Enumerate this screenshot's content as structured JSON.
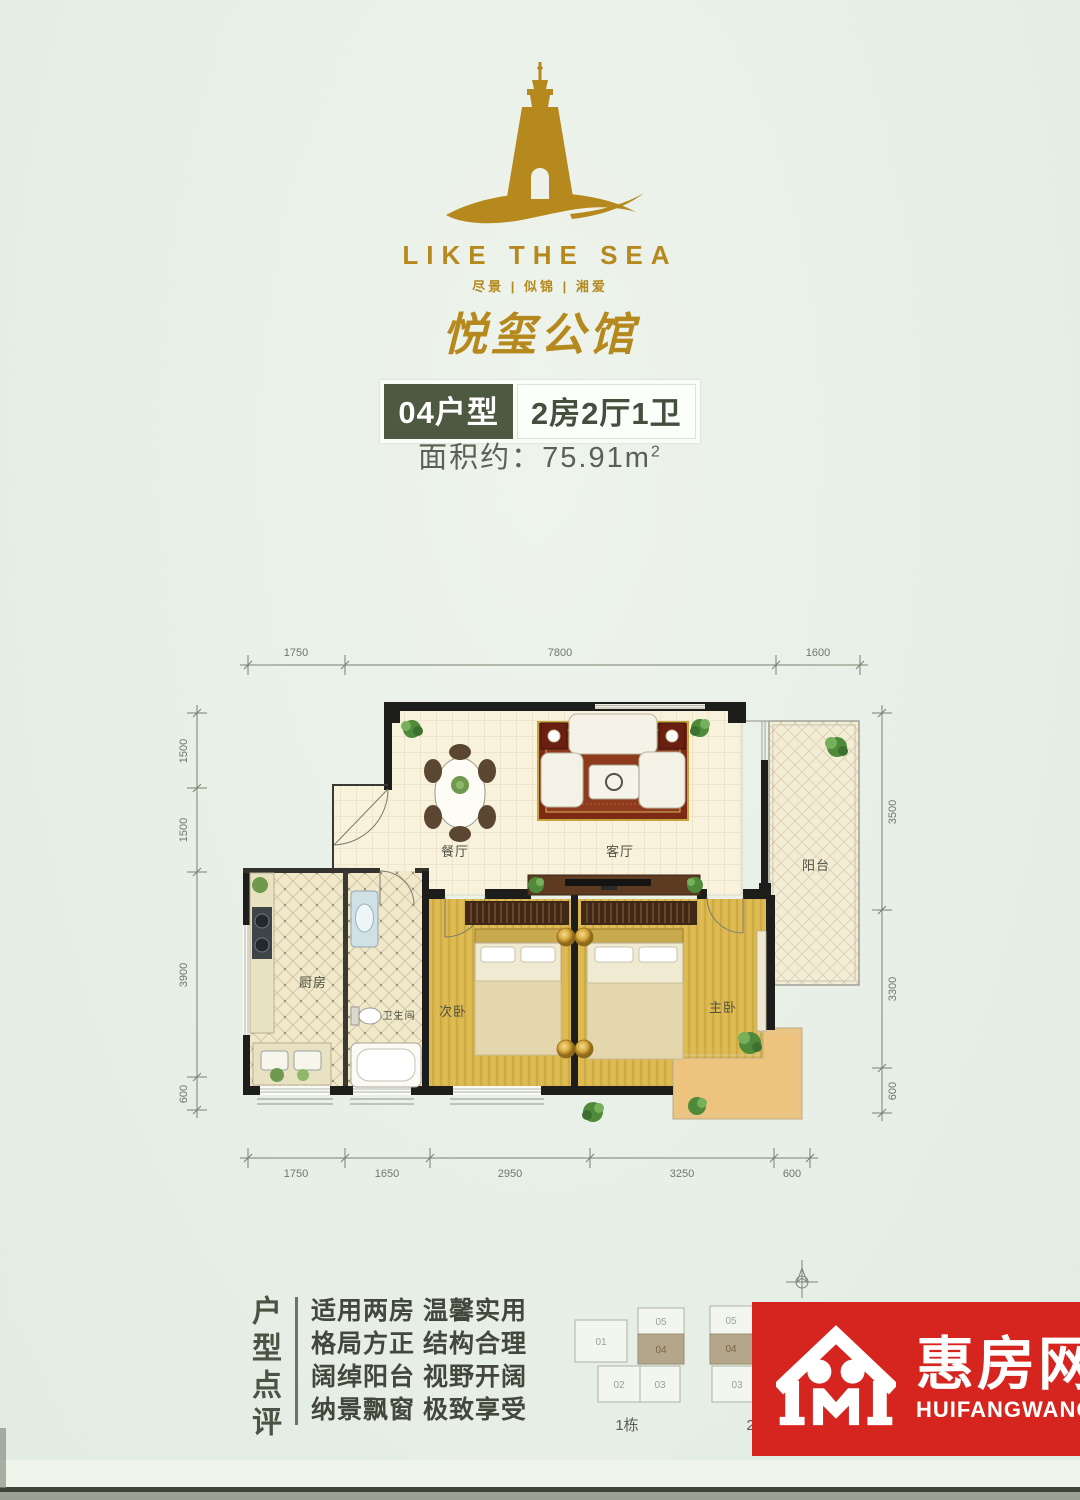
{
  "logo": {
    "en": "LIKE THE SEA",
    "tagline": "尽景 | 似锦 | 湘爱",
    "brand": "悦玺公馆"
  },
  "unit": {
    "type": "04户型",
    "layout": "2房2厅1卫",
    "area_prefix": "面积约：75.91m",
    "area_sup": "2"
  },
  "plan": {
    "rooms": {
      "dining": "餐厅",
      "living": "客厅",
      "balcony": "阳台",
      "kitchen": "厨房",
      "bath": "卫生间",
      "bed2": "次卧",
      "master": "主卧"
    },
    "dims_top": [
      "1750",
      "7800",
      "1600"
    ],
    "dims_bottom": [
      "1750",
      "1650",
      "2950",
      "3250",
      "600"
    ],
    "dims_left": [
      "1500",
      "1500",
      "3900",
      "600"
    ],
    "dims_right": [
      "3500",
      "3300",
      "600"
    ]
  },
  "review": {
    "title": "户型点评",
    "lines": [
      "适用两房 温馨实用",
      "格局方正 结构合理",
      "阔绰阳台 视野开阔",
      "纳景飘窗 极致享受"
    ]
  },
  "keyplan": {
    "building1": {
      "label": "1栋",
      "units": [
        "01",
        "05",
        "04",
        "02",
        "03"
      ]
    },
    "building2": {
      "label": "2栋",
      "units": [
        "05",
        "04",
        "03"
      ]
    }
  },
  "watermark": {
    "brand": "惠房网",
    "latin": "HUIFANGWANG"
  },
  "colors": {
    "gold": "#b6891e",
    "badge_green": "#4e5941",
    "watermark_red": "#d6241f",
    "wall": "#1d1d1b",
    "unit_highlight": "#b3a68a"
  }
}
